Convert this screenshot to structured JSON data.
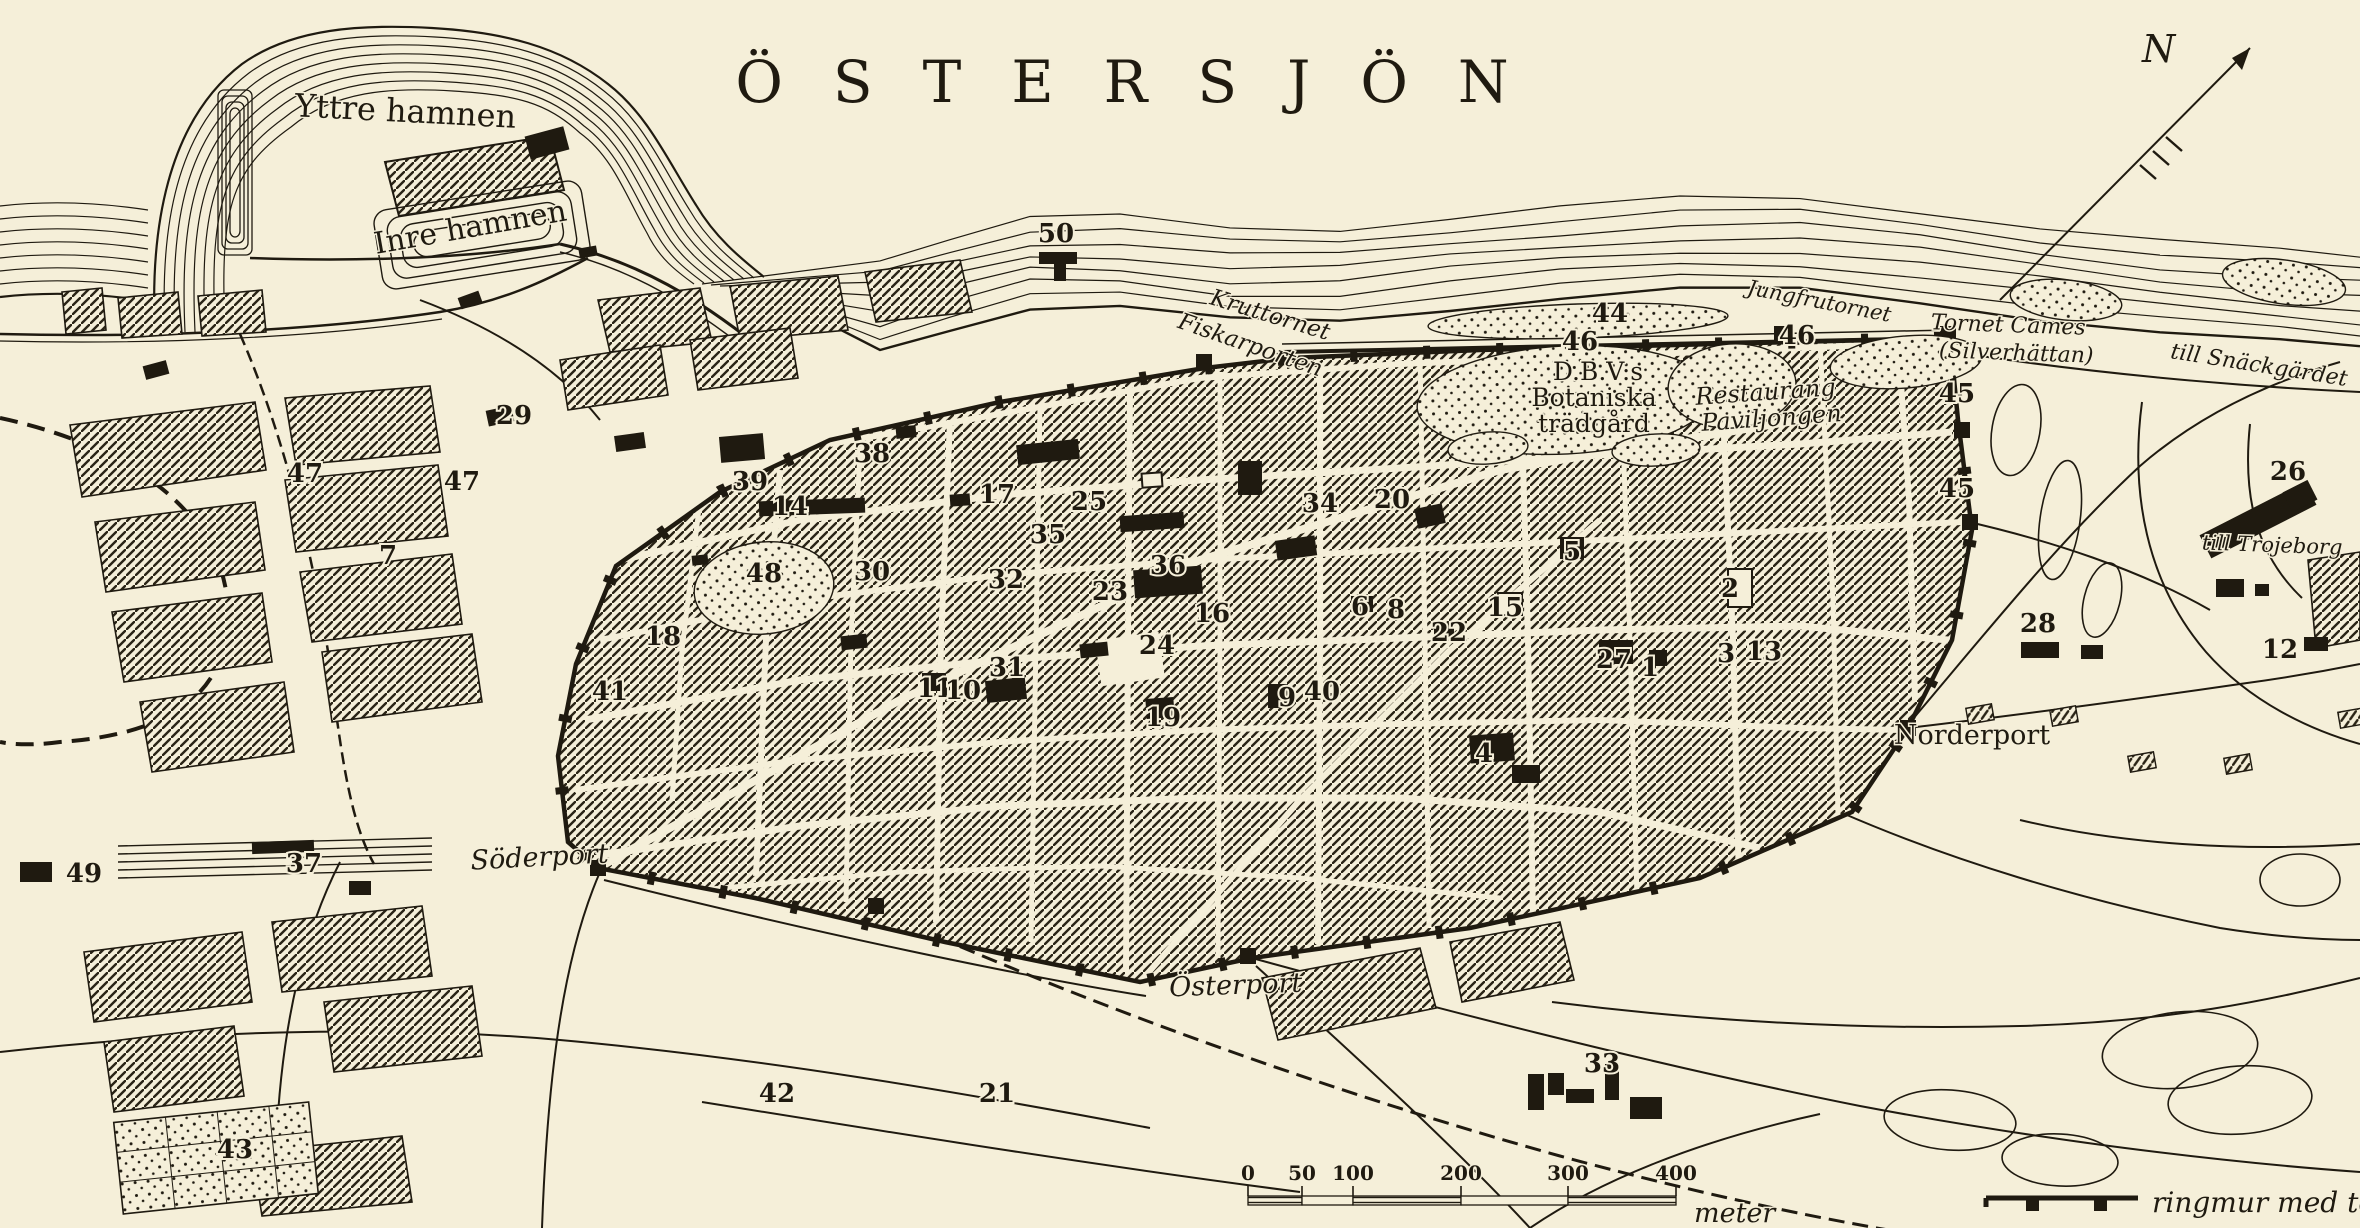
{
  "title": "ÖSTERSJÖN",
  "compass": {
    "label": "N"
  },
  "colors": {
    "paper": "#f5efd9",
    "ink": "#1f1a10"
  },
  "labels": [
    {
      "text": "Yttre hamnen",
      "x": 405,
      "y": 122,
      "size": 32,
      "rot": 3,
      "style": "roman"
    },
    {
      "text": "Inre hamnen",
      "x": 472,
      "y": 237,
      "size": 30,
      "rot": -10,
      "style": "roman"
    },
    {
      "text": "Kruttornet",
      "x": 1268,
      "y": 322,
      "size": 23,
      "rot": 17,
      "style": "italic"
    },
    {
      "text": "Fiskarporten",
      "x": 1248,
      "y": 352,
      "size": 23,
      "rot": 19,
      "style": "italic"
    },
    {
      "text": "Jungfrutornet",
      "x": 1818,
      "y": 308,
      "size": 21,
      "rot": 11,
      "style": "italic"
    },
    {
      "text": "Tornet Cames",
      "x": 2008,
      "y": 332,
      "size": 22,
      "rot": 2,
      "style": "italic"
    },
    {
      "text": "(Silverhättan)",
      "x": 2016,
      "y": 360,
      "size": 22,
      "rot": 2,
      "style": "italic"
    },
    {
      "text": "till Snäckgärdet",
      "x": 2258,
      "y": 372,
      "size": 22,
      "rot": 9,
      "style": "italic"
    },
    {
      "text": "till Trojeborg",
      "x": 2272,
      "y": 552,
      "size": 21,
      "rot": 2,
      "style": "italic"
    },
    {
      "text": "D.B.V:s",
      "x": 1598,
      "y": 380,
      "size": 25,
      "rot": 0,
      "style": "roman"
    },
    {
      "text": "Botaniska",
      "x": 1594,
      "y": 406,
      "size": 25,
      "rot": 0,
      "style": "roman"
    },
    {
      "text": "trädgård",
      "x": 1594,
      "y": 432,
      "size": 25,
      "rot": 0,
      "style": "roman"
    },
    {
      "text": "Restaurang",
      "x": 1766,
      "y": 400,
      "size": 24,
      "rot": -4,
      "style": "italic"
    },
    {
      "text": "Paviljongen",
      "x": 1772,
      "y": 426,
      "size": 24,
      "rot": -4,
      "style": "italic"
    },
    {
      "text": "Norderport",
      "x": 1972,
      "y": 744,
      "size": 27,
      "rot": 0,
      "style": "roman"
    },
    {
      "text": "Söderport",
      "x": 540,
      "y": 866,
      "size": 27,
      "rot": -3,
      "style": "italic"
    },
    {
      "text": "Österport",
      "x": 1236,
      "y": 994,
      "size": 27,
      "rot": -2,
      "style": "italic"
    }
  ],
  "numbers": [
    {
      "n": "50",
      "x": 1056,
      "y": 242
    },
    {
      "n": "47",
      "x": 305,
      "y": 482
    },
    {
      "n": "47",
      "x": 462,
      "y": 490
    },
    {
      "n": "29",
      "x": 514,
      "y": 424
    },
    {
      "n": "38",
      "x": 872,
      "y": 462
    },
    {
      "n": "39",
      "x": 750,
      "y": 490
    },
    {
      "n": "14",
      "x": 790,
      "y": 515
    },
    {
      "n": "17",
      "x": 997,
      "y": 503
    },
    {
      "n": "25",
      "x": 1089,
      "y": 510
    },
    {
      "n": "35",
      "x": 1048,
      "y": 543
    },
    {
      "n": "30",
      "x": 872,
      "y": 580
    },
    {
      "n": "48",
      "x": 764,
      "y": 582
    },
    {
      "n": "32",
      "x": 1006,
      "y": 588
    },
    {
      "n": "23",
      "x": 1110,
      "y": 600
    },
    {
      "n": "36",
      "x": 1168,
      "y": 574
    },
    {
      "n": "16",
      "x": 1212,
      "y": 622
    },
    {
      "n": "18",
      "x": 663,
      "y": 645
    },
    {
      "n": "24",
      "x": 1157,
      "y": 654
    },
    {
      "n": "31",
      "x": 1007,
      "y": 676
    },
    {
      "n": "11",
      "x": 935,
      "y": 697
    },
    {
      "n": "10",
      "x": 963,
      "y": 699
    },
    {
      "n": "19",
      "x": 1163,
      "y": 726
    },
    {
      "n": "9",
      "x": 1287,
      "y": 706
    },
    {
      "n": "40",
      "x": 1322,
      "y": 700
    },
    {
      "n": "34",
      "x": 1320,
      "y": 512
    },
    {
      "n": "20",
      "x": 1392,
      "y": 508
    },
    {
      "n": "6",
      "x": 1360,
      "y": 615
    },
    {
      "n": "8",
      "x": 1396,
      "y": 618
    },
    {
      "n": "22",
      "x": 1449,
      "y": 641
    },
    {
      "n": "15",
      "x": 1505,
      "y": 616
    },
    {
      "n": "5",
      "x": 1572,
      "y": 560
    },
    {
      "n": "2",
      "x": 1730,
      "y": 597
    },
    {
      "n": "3",
      "x": 1726,
      "y": 662
    },
    {
      "n": "27",
      "x": 1614,
      "y": 668
    },
    {
      "n": "1",
      "x": 1650,
      "y": 676
    },
    {
      "n": "13",
      "x": 1764,
      "y": 660
    },
    {
      "n": "4",
      "x": 1484,
      "y": 762
    },
    {
      "n": "44",
      "x": 1610,
      "y": 322
    },
    {
      "n": "46",
      "x": 1580,
      "y": 350
    },
    {
      "n": "46",
      "x": 1797,
      "y": 344
    },
    {
      "n": "45",
      "x": 1957,
      "y": 402
    },
    {
      "n": "45",
      "x": 1957,
      "y": 497
    },
    {
      "n": "26",
      "x": 2288,
      "y": 480
    },
    {
      "n": "28",
      "x": 2038,
      "y": 632
    },
    {
      "n": "12",
      "x": 2280,
      "y": 658
    },
    {
      "n": "7",
      "x": 388,
      "y": 564
    },
    {
      "n": "41",
      "x": 610,
      "y": 700
    },
    {
      "n": "37",
      "x": 304,
      "y": 872
    },
    {
      "n": "49",
      "x": 84,
      "y": 882
    },
    {
      "n": "43",
      "x": 235,
      "y": 1158
    },
    {
      "n": "42",
      "x": 777,
      "y": 1102
    },
    {
      "n": "21",
      "x": 997,
      "y": 1102
    },
    {
      "n": "33",
      "x": 1602,
      "y": 1072
    }
  ],
  "scale_bar": {
    "unit": "meter",
    "ticks": [
      {
        "label": "0",
        "x": 1248
      },
      {
        "label": "50",
        "x": 1302
      },
      {
        "label": "100",
        "x": 1353
      },
      {
        "label": "200",
        "x": 1461
      },
      {
        "label": "300",
        "x": 1568
      },
      {
        "label": "400",
        "x": 1676
      }
    ]
  },
  "legend": {
    "label": "ringmur med torn"
  }
}
